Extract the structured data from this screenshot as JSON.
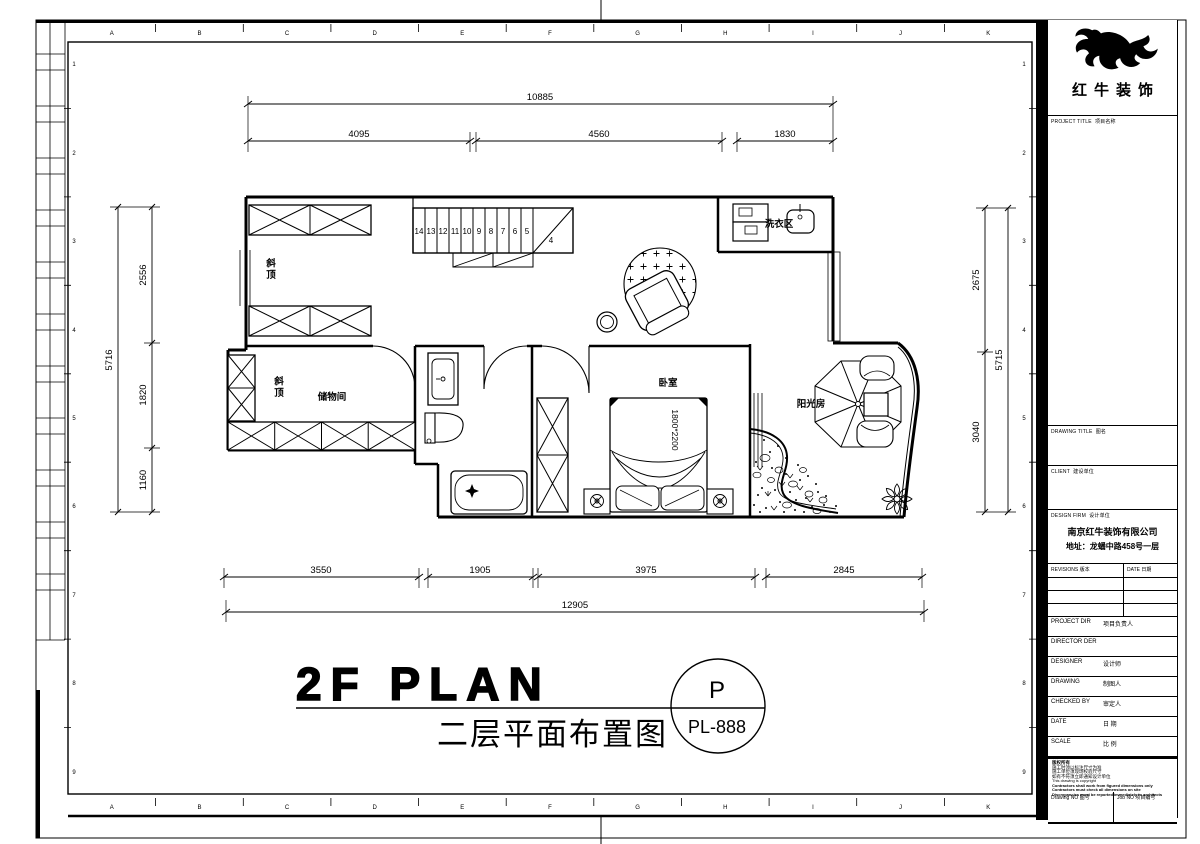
{
  "sheet": {
    "grid_letters": [
      "A",
      "B",
      "C",
      "D",
      "E",
      "F",
      "G",
      "H",
      "I",
      "J",
      "K"
    ],
    "grid_numbers": [
      "1",
      "2",
      "3",
      "4",
      "5",
      "6",
      "7",
      "8",
      "9"
    ]
  },
  "plan": {
    "labels": {
      "sloped_ceiling": "斜顶",
      "storage": "储物间",
      "bedroom": "卧室",
      "sunroom": "阳光房",
      "laundry": "洗衣区",
      "bed_size": "1800*2200"
    },
    "stairs": [
      "14",
      "13",
      "12",
      "11",
      "10",
      "9",
      "8",
      "7",
      "6",
      "5",
      "4"
    ],
    "dims": {
      "top_total": "10885",
      "top": [
        "4095",
        "4560",
        "1830"
      ],
      "left_total": "5716",
      "left": [
        "2556",
        "1820",
        "1160"
      ],
      "right_total": "5715",
      "right": [
        "2675",
        "3040"
      ],
      "bottom": [
        "3550",
        "1905",
        "3975",
        "2845"
      ],
      "bottom_total": "12905"
    }
  },
  "title": {
    "en": "2F PLAN",
    "zh": "二层平面布置图",
    "marker_top": "P",
    "marker_code": "PL-888"
  },
  "titleblock": {
    "brand": "红牛装饰",
    "project_title_en": "PROJECT TITLE",
    "project_title_zh": "项目名称",
    "drawing_title_en": "DRAWING TITLE",
    "drawing_title_zh": "图名",
    "client_en": "CLIENT",
    "client_zh": "建设单位",
    "design_firm_en": "DESIGN FIRM",
    "design_firm_zh": "设计单位",
    "company": "南京红牛装饰有限公司",
    "address": "地址：龙蟠中路458号一层",
    "revisions_en": "REVISIONS",
    "revisions_zh": "版本",
    "date_en": "DATE",
    "date_zh": "日期",
    "fields": [
      {
        "en": "PROJECT DIR",
        "zh": "项目负责人"
      },
      {
        "en": "DIRECTOR DER",
        "zh": ""
      },
      {
        "en": "DESIGNER",
        "zh": "设计师"
      },
      {
        "en": "DRAWING",
        "zh": "制图人"
      },
      {
        "en": "CHECKED BY",
        "zh": "审定人"
      },
      {
        "en": "DATE",
        "zh": "日 期"
      },
      {
        "en": "SCALE",
        "zh": "比 例"
      }
    ],
    "copyright": [
      "版权所有",
      "施工时须以标注尺寸为准",
      "施工单位须现场校验尺寸",
      "如有不符须立即通知设计单位",
      "This drawing is copyright",
      "Contractors shall work from figured dimensions only",
      "Contractors must check all dimensions on site",
      "Discrepancies must be reported immediately to architects"
    ],
    "drawing_no_en": "Drawing NO",
    "drawing_no_zh": "图号",
    "job_no_en": "Job NO",
    "job_no_zh": "项目编号"
  }
}
